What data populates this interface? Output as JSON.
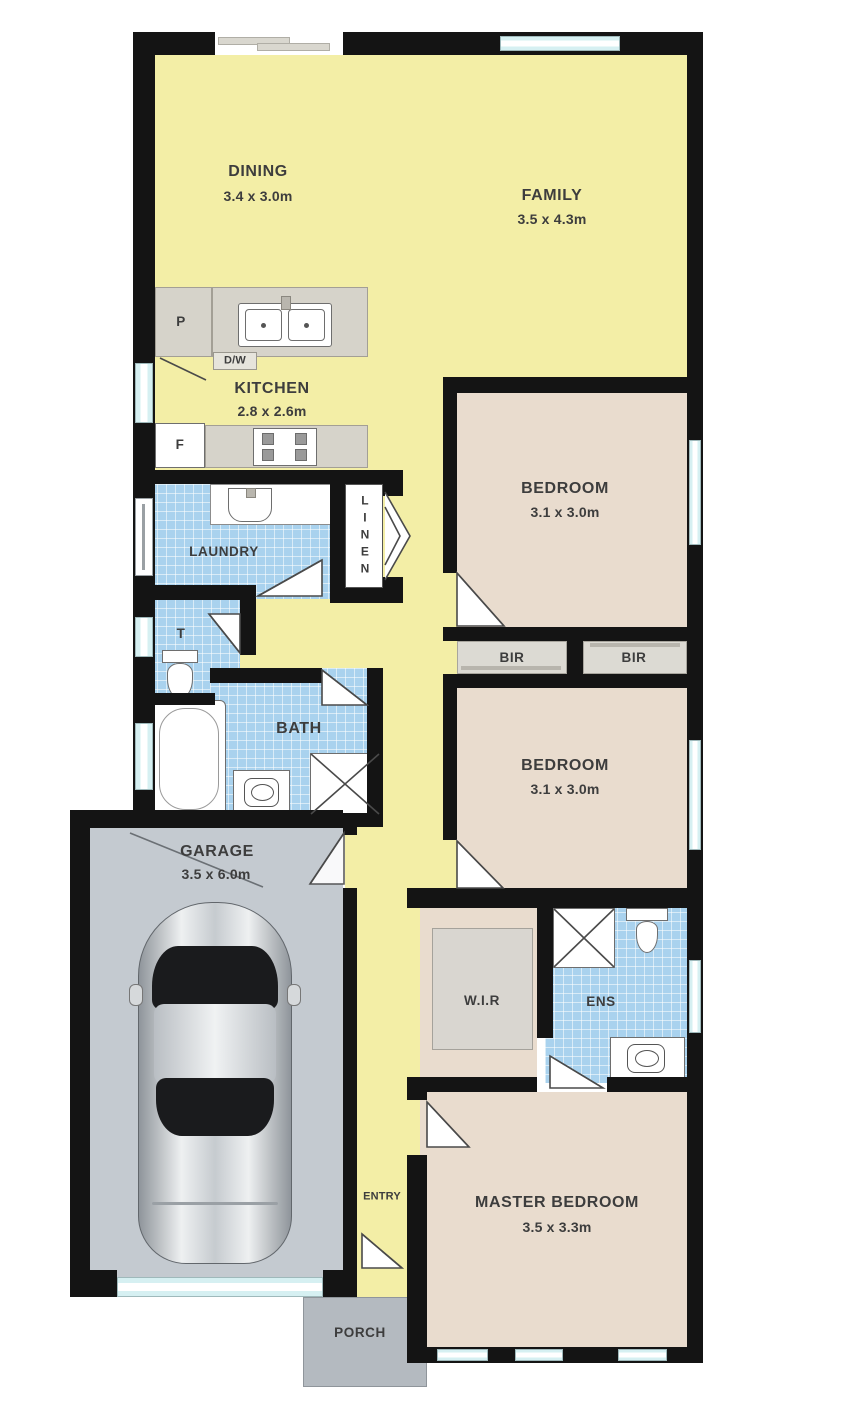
{
  "plan_title": "Single storey house floor plan",
  "colors": {
    "wall": "#141414",
    "living_yellow": "#f3eea6",
    "bedroom_tan": "#e9dcce",
    "wet_area_tile": "#a9d2ee",
    "garage_floor": "#c4cad0",
    "porch_floor": "#b4bac0",
    "bench_gray": "#d6d3ca",
    "window_cyan": "#d6f0f2"
  },
  "rooms": {
    "dining": {
      "name": "DINING",
      "dims": "3.4 x 3.0m"
    },
    "family": {
      "name": "FAMILY",
      "dims": "3.5 x 4.3m"
    },
    "kitchen": {
      "name": "KITCHEN",
      "dims": "2.8 x 2.6m"
    },
    "laundry": {
      "name": "LAUNDRY"
    },
    "linen": {
      "name": "LINEN"
    },
    "toilet": {
      "name": "T"
    },
    "bath": {
      "name": "BATH"
    },
    "bedroom1": {
      "name": "BEDROOM",
      "dims": "3.1 x 3.0m"
    },
    "bir1": {
      "name": "BIR"
    },
    "bir2": {
      "name": "BIR"
    },
    "bedroom2": {
      "name": "BEDROOM",
      "dims": "3.1 x 3.0m"
    },
    "garage": {
      "name": "GARAGE",
      "dims": "3.5 x 6.0m"
    },
    "wir": {
      "name": "W.I.R"
    },
    "ens": {
      "name": "ENS"
    },
    "master": {
      "name": "MASTER BEDROOM",
      "dims": "3.5 x 3.3m"
    },
    "entry": {
      "name": "ENTRY"
    },
    "porch": {
      "name": "PORCH"
    }
  },
  "appliances": {
    "pantry": "P",
    "fridge": "F",
    "dishwasher": "D/W"
  }
}
